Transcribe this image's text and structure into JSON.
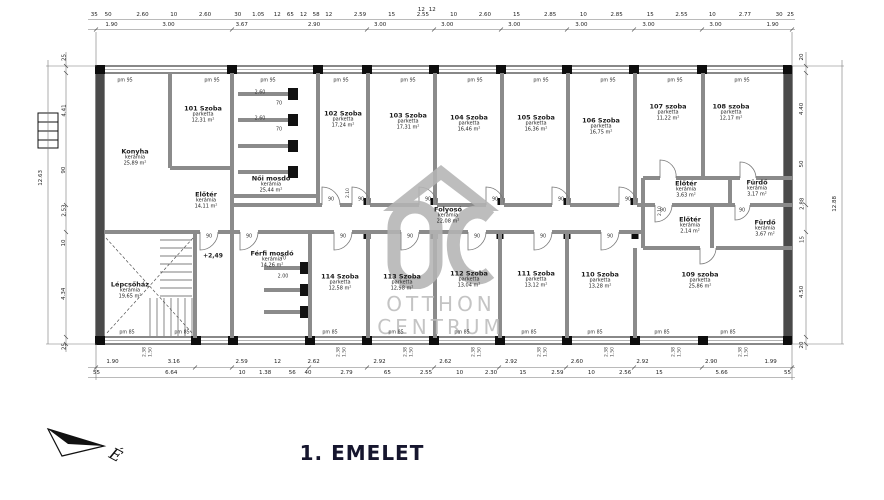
{
  "title": "1. EMELET",
  "north": {
    "label": "É"
  },
  "watermark": {
    "line1": "OTTHON",
    "line2": "CENTRUM"
  },
  "labels": {
    "pm_top": "pm 95",
    "pm_bottom": "pm 85",
    "door_width": "90",
    "door_height": "2.10",
    "level": "+2,49",
    "sill_a": "2.38",
    "sill_b": "1.50",
    "stall_depth": "2.60",
    "stall_depth2": "2.00",
    "stall_width": "70",
    "left_total": "12.63",
    "right_total": "12.88"
  },
  "rooms": [
    {
      "name": "Konyha",
      "material": "kerámia",
      "area": "25,89 m²"
    },
    {
      "name": "101 Szoba",
      "material": "parketta",
      "area": "12,31 m²"
    },
    {
      "name": "Női mosdó",
      "material": "kerámia",
      "area": "25,44 m²"
    },
    {
      "name": "102 Szoba",
      "material": "parketta",
      "area": "17,24 m²"
    },
    {
      "name": "103 Szoba",
      "material": "parketta",
      "area": "17,31 m²"
    },
    {
      "name": "104 Szoba",
      "material": "parketta",
      "area": "16,46 m²"
    },
    {
      "name": "105 Szoba",
      "material": "parketta",
      "area": "16,36 m²"
    },
    {
      "name": "106 Szoba",
      "material": "parketta",
      "area": "16,75 m²"
    },
    {
      "name": "107 szoba",
      "material": "parketta",
      "area": "11,22 m²"
    },
    {
      "name": "108 szoba",
      "material": "parketta",
      "area": "12,17 m²"
    },
    {
      "name": "Előtér",
      "material": "kerámia",
      "area": "14,11 m²"
    },
    {
      "name": "Folyosó",
      "material": "kerámia",
      "area": "22,08 m²"
    },
    {
      "name": "Előtér",
      "material": "kerámia",
      "area": "3,63 m²"
    },
    {
      "name": "Fürdő",
      "material": "kerámia",
      "area": "3,17 m²"
    },
    {
      "name": "Előtér",
      "material": "kerámia",
      "area": "2,14 m²"
    },
    {
      "name": "Fürdő",
      "material": "kerámia",
      "area": "3,67 m²"
    },
    {
      "name": "Lépcsőház",
      "material": "kerámia",
      "area": "19,65 m²"
    },
    {
      "name": "Férfi mosdó",
      "material": "kerámia",
      "area": "14,26 m²"
    },
    {
      "name": "114 Szoba",
      "material": "parketta",
      "area": "12,58 m²"
    },
    {
      "name": "113 Szoba",
      "material": "parketta",
      "area": "12,98 m²"
    },
    {
      "name": "112 Szoba",
      "material": "parketta",
      "area": "13,04 m²"
    },
    {
      "name": "111 Szoba",
      "material": "parketta",
      "area": "13,12 m²"
    },
    {
      "name": "110 Szoba",
      "material": "parketta",
      "area": "13,28 m²"
    },
    {
      "name": "109 szoba",
      "material": "parketta",
      "area": "25,86 m²"
    }
  ],
  "dims": {
    "top0": [
      "12",
      "12"
    ],
    "top1": [
      "35",
      "50",
      "2.60",
      "10",
      "2.60",
      "30",
      "1.05",
      "12",
      "65",
      "12",
      "58",
      "12",
      "2.59",
      "15",
      "2.55",
      "10",
      "2.60",
      "15",
      "2.85",
      "10",
      "2.85",
      "15",
      "2.55",
      "10",
      "2.77",
      "30",
      "25"
    ],
    "top2": [
      "1.90",
      "3.00",
      "3.67",
      "2.90",
      "3.00",
      "3.00",
      "3.00",
      "3.00",
      "3.00",
      "3.00",
      "1.90"
    ],
    "bottom1": [
      "1.90",
      "3.16",
      "2.59",
      "12",
      "2.62",
      "2.92",
      "2.62",
      "2.92",
      "2.60",
      "2.92",
      "2.90",
      "1.99"
    ],
    "bottom2": [
      "55",
      "6.64",
      "10",
      "1.38",
      "56",
      "40",
      "2.79",
      "65",
      "2.55",
      "10",
      "2.30",
      "15",
      "2.59",
      "10",
      "2.56",
      "15",
      "5.66",
      "55"
    ],
    "left": [
      "25",
      "4.41",
      "90",
      "2.53",
      "10",
      "4.34",
      "25"
    ],
    "right": [
      "20",
      "4.40",
      "50",
      "2.88",
      "15",
      "4.50",
      "20"
    ]
  }
}
